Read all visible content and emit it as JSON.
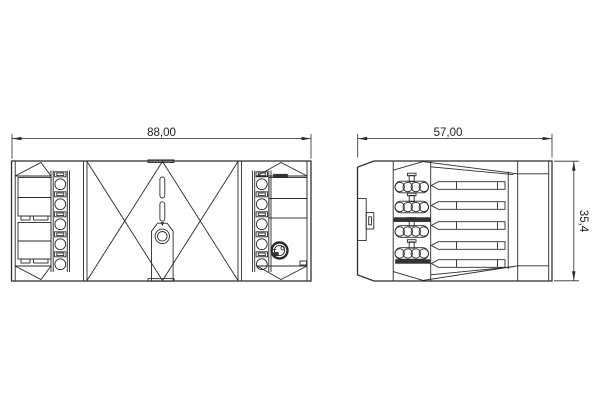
{
  "drawing": {
    "background_color": "#ffffff",
    "line_color": "#2a2a2a",
    "dimensions": {
      "front_width": "88,00",
      "side_width": "57,00",
      "side_height": "35,4"
    }
  }
}
